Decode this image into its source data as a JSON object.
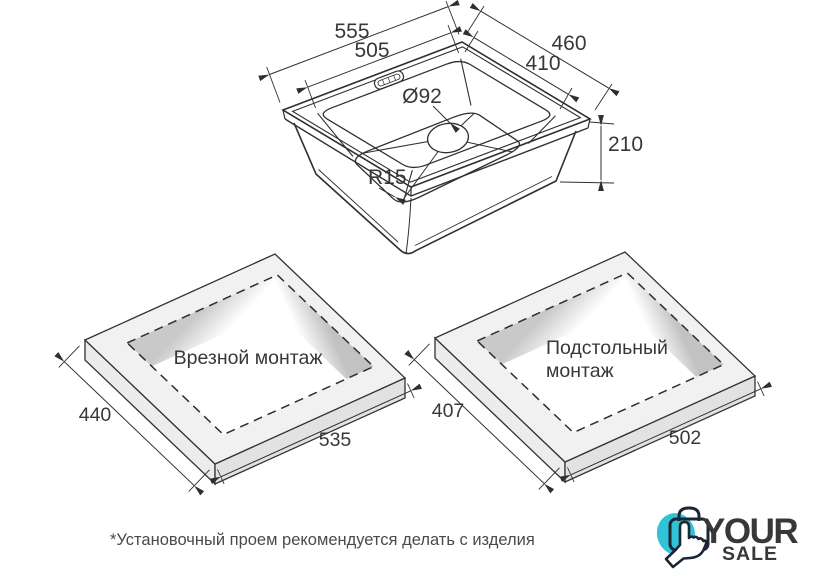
{
  "sink": {
    "outer_width": "555",
    "inner_width": "505",
    "outer_depth": "460",
    "inner_depth": "410",
    "drain": "Ø92",
    "corner_radius": "R15",
    "height": "210"
  },
  "flush_mount": {
    "title": "Врезной монтаж",
    "side": "440",
    "front": "535"
  },
  "under_mount": {
    "title_lines": [
      "Подстольный",
      "монтаж"
    ],
    "side": "407",
    "front": "502"
  },
  "footnote": "*Установочный проем рекомендуется делать с изделия",
  "logo": {
    "your": "YOUR",
    "sale": "SALE",
    "navy": "#1c2733",
    "teal": "#31c3d7"
  }
}
